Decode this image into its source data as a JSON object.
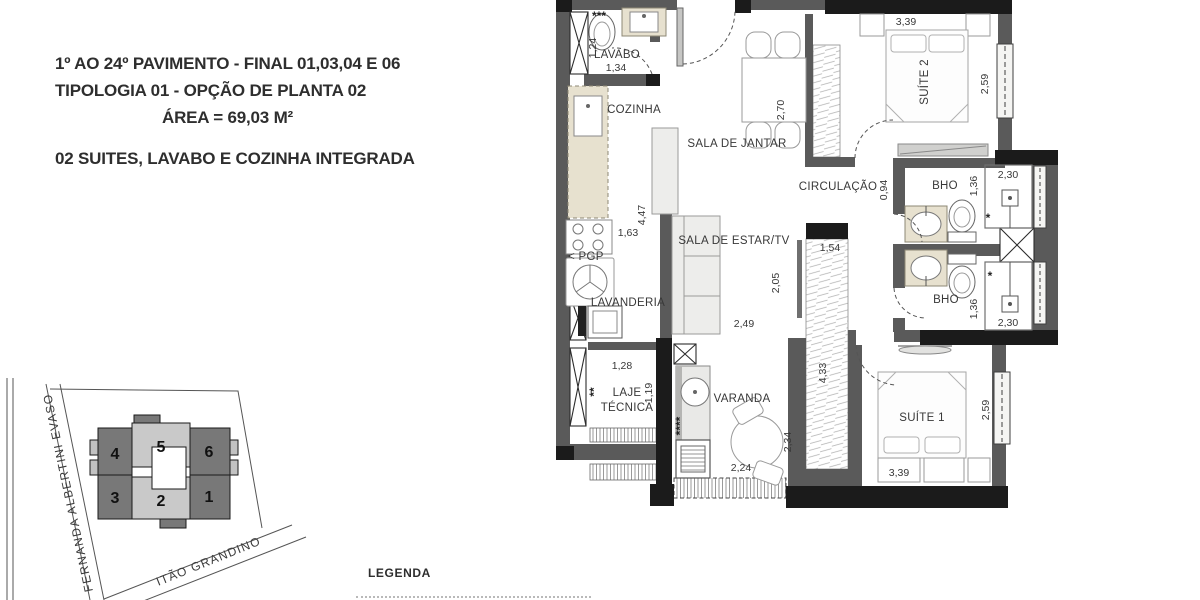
{
  "title_block": {
    "line1": "1º AO 24º PAVIMENTO - FINAL 01,03,04 E 06",
    "line2": "TIPOLOGIA 01 - OPÇÃO DE PLANTA 02",
    "line3": "ÁREA = 69,03 M²",
    "subtitle": "02 SUITES, LAVABO E COZINHA INTEGRADA"
  },
  "legend": {
    "title": "LEGENDA"
  },
  "site_plan": {
    "street_left": "FERNANDA ALBERTINI EVASO",
    "street_bottom": "ITÃO GRANDINO",
    "units": {
      "u1": "1",
      "u2": "2",
      "u3": "3",
      "u4": "4",
      "u5": "5",
      "u6": "6"
    }
  },
  "floor_plan": {
    "rooms": {
      "lavabo": "LAVABO",
      "cozinha": "COZINHA",
      "sala_de_jantar": "SALA DE JANTAR",
      "circulacao": "CIRCULAÇÃO",
      "sala_de_estar": "SALA DE ESTAR/TV",
      "lavanderia": "LAVANDERIA",
      "laje_line1": "LAJE",
      "laje_line2": "TÉCNICA",
      "varanda": "VARANDA",
      "suite1": "SUÍTE 1",
      "suite2": "SUÍTE 2",
      "bho_top": "BHO",
      "bho_bottom": "BHO",
      "pgp": "< PGP"
    },
    "dimensions": {
      "lavabo_w": "1,34",
      "lavabo_h": "1,24",
      "cozinha_w": "1,63",
      "cozinha_h": "4,47",
      "jantar_h": "2,70",
      "estar_w": "2,49",
      "estar_h": "2,05",
      "closet_top": "1,54",
      "closet_h": "4,33",
      "circ_h": "0,94",
      "suite2_w": "3,39",
      "suite2_h": "2,59",
      "bho_top_w": "2,30",
      "bho_top_h": "1,36",
      "bho_bottom_w": "2,30",
      "bho_bottom_h": "1,36",
      "laje_w": "1,28",
      "laje_h": "1,19",
      "varanda_w": "2,24",
      "varanda_h": "2,34",
      "suite1_w": "3,39",
      "suite1_h": "2,59"
    },
    "annotations": {
      "stars_lavabo": "***",
      "stars_laje": "**",
      "stars_varanda": "****",
      "star_bho_top": "*",
      "star_bho_bottom": "*"
    }
  }
}
